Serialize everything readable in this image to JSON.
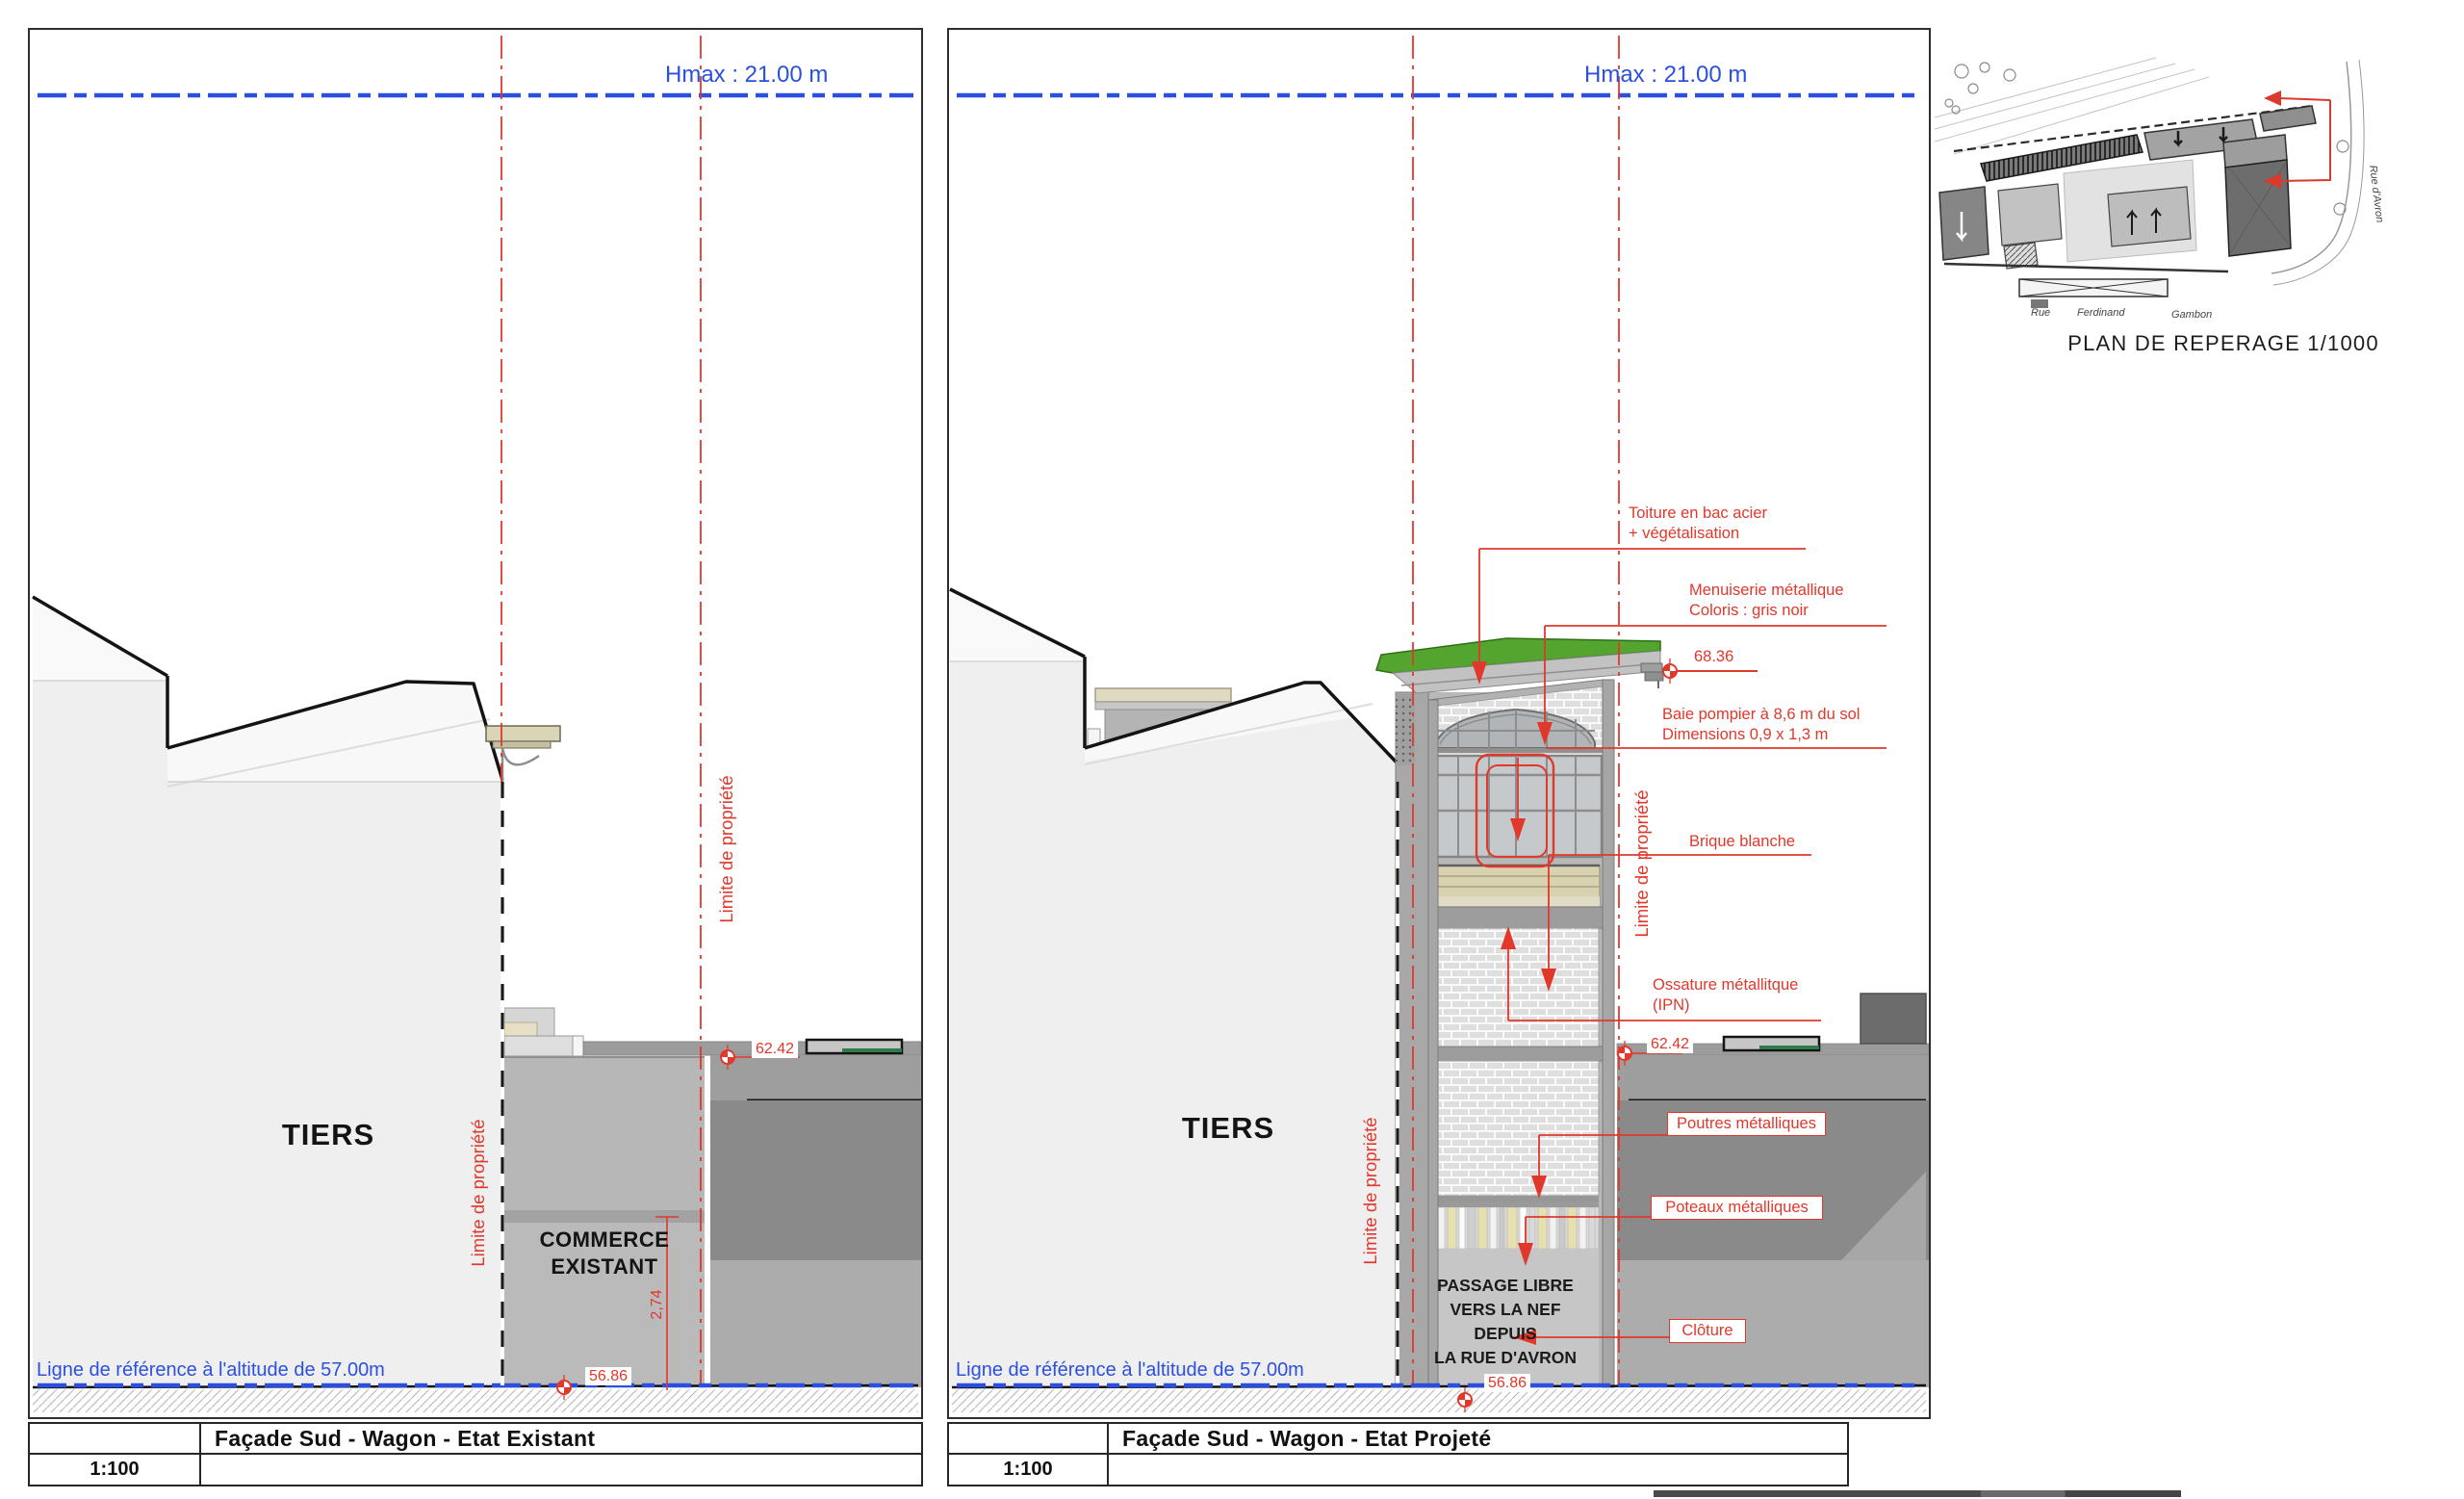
{
  "colors": {
    "blue": "#2b50e0",
    "red": "#e0382b",
    "green_roof": "#54a52f"
  },
  "shared": {
    "hmax": "Hmax : 21.00 m",
    "ref_line": "Ligne de référence à l'altitude de 57.00m",
    "limite": "Limite de propriété",
    "tiers": "TIERS",
    "scale": "1:100",
    "level_5686": "56.86",
    "level_6242": "62.42"
  },
  "left_panel": {
    "title": "Façade Sud - Wagon - Etat Existant",
    "commerce_line1": "COMMERCE",
    "commerce_line2": "EXISTANT",
    "dim_274": "2,74"
  },
  "right_panel": {
    "title": "Façade Sud - Wagon - Etat Projeté",
    "level_6836": "68.36",
    "passage_line1": "PASSAGE LIBRE",
    "passage_line2": "VERS LA NEF DEPUIS",
    "passage_line3": "LA RUE D'AVRON",
    "annotations": {
      "toiture_l1": "Toiture en bac acier",
      "toiture_l2": "+ végétalisation",
      "menuiserie_l1": "Menuiserie métallique",
      "menuiserie_l2": "Coloris : gris noir",
      "baie_l1": "Baie pompier à 8,6 m du sol",
      "baie_l2": "Dimensions 0,9 x 1,3 m",
      "brique": "Brique blanche",
      "ossature_l1": "Ossature métallitque",
      "ossature_l2": "(IPN)",
      "poutres": "Poutres métalliques",
      "poteaux": "Poteaux métalliques",
      "cloture": "Clôture"
    }
  },
  "plan": {
    "caption": "PLAN DE REPERAGE 1/1000",
    "street_rue": "Rue",
    "street_ferdinand": "Ferdinand",
    "street_gambon": "Gambon",
    "street_avron": "Rue d'Avron"
  }
}
